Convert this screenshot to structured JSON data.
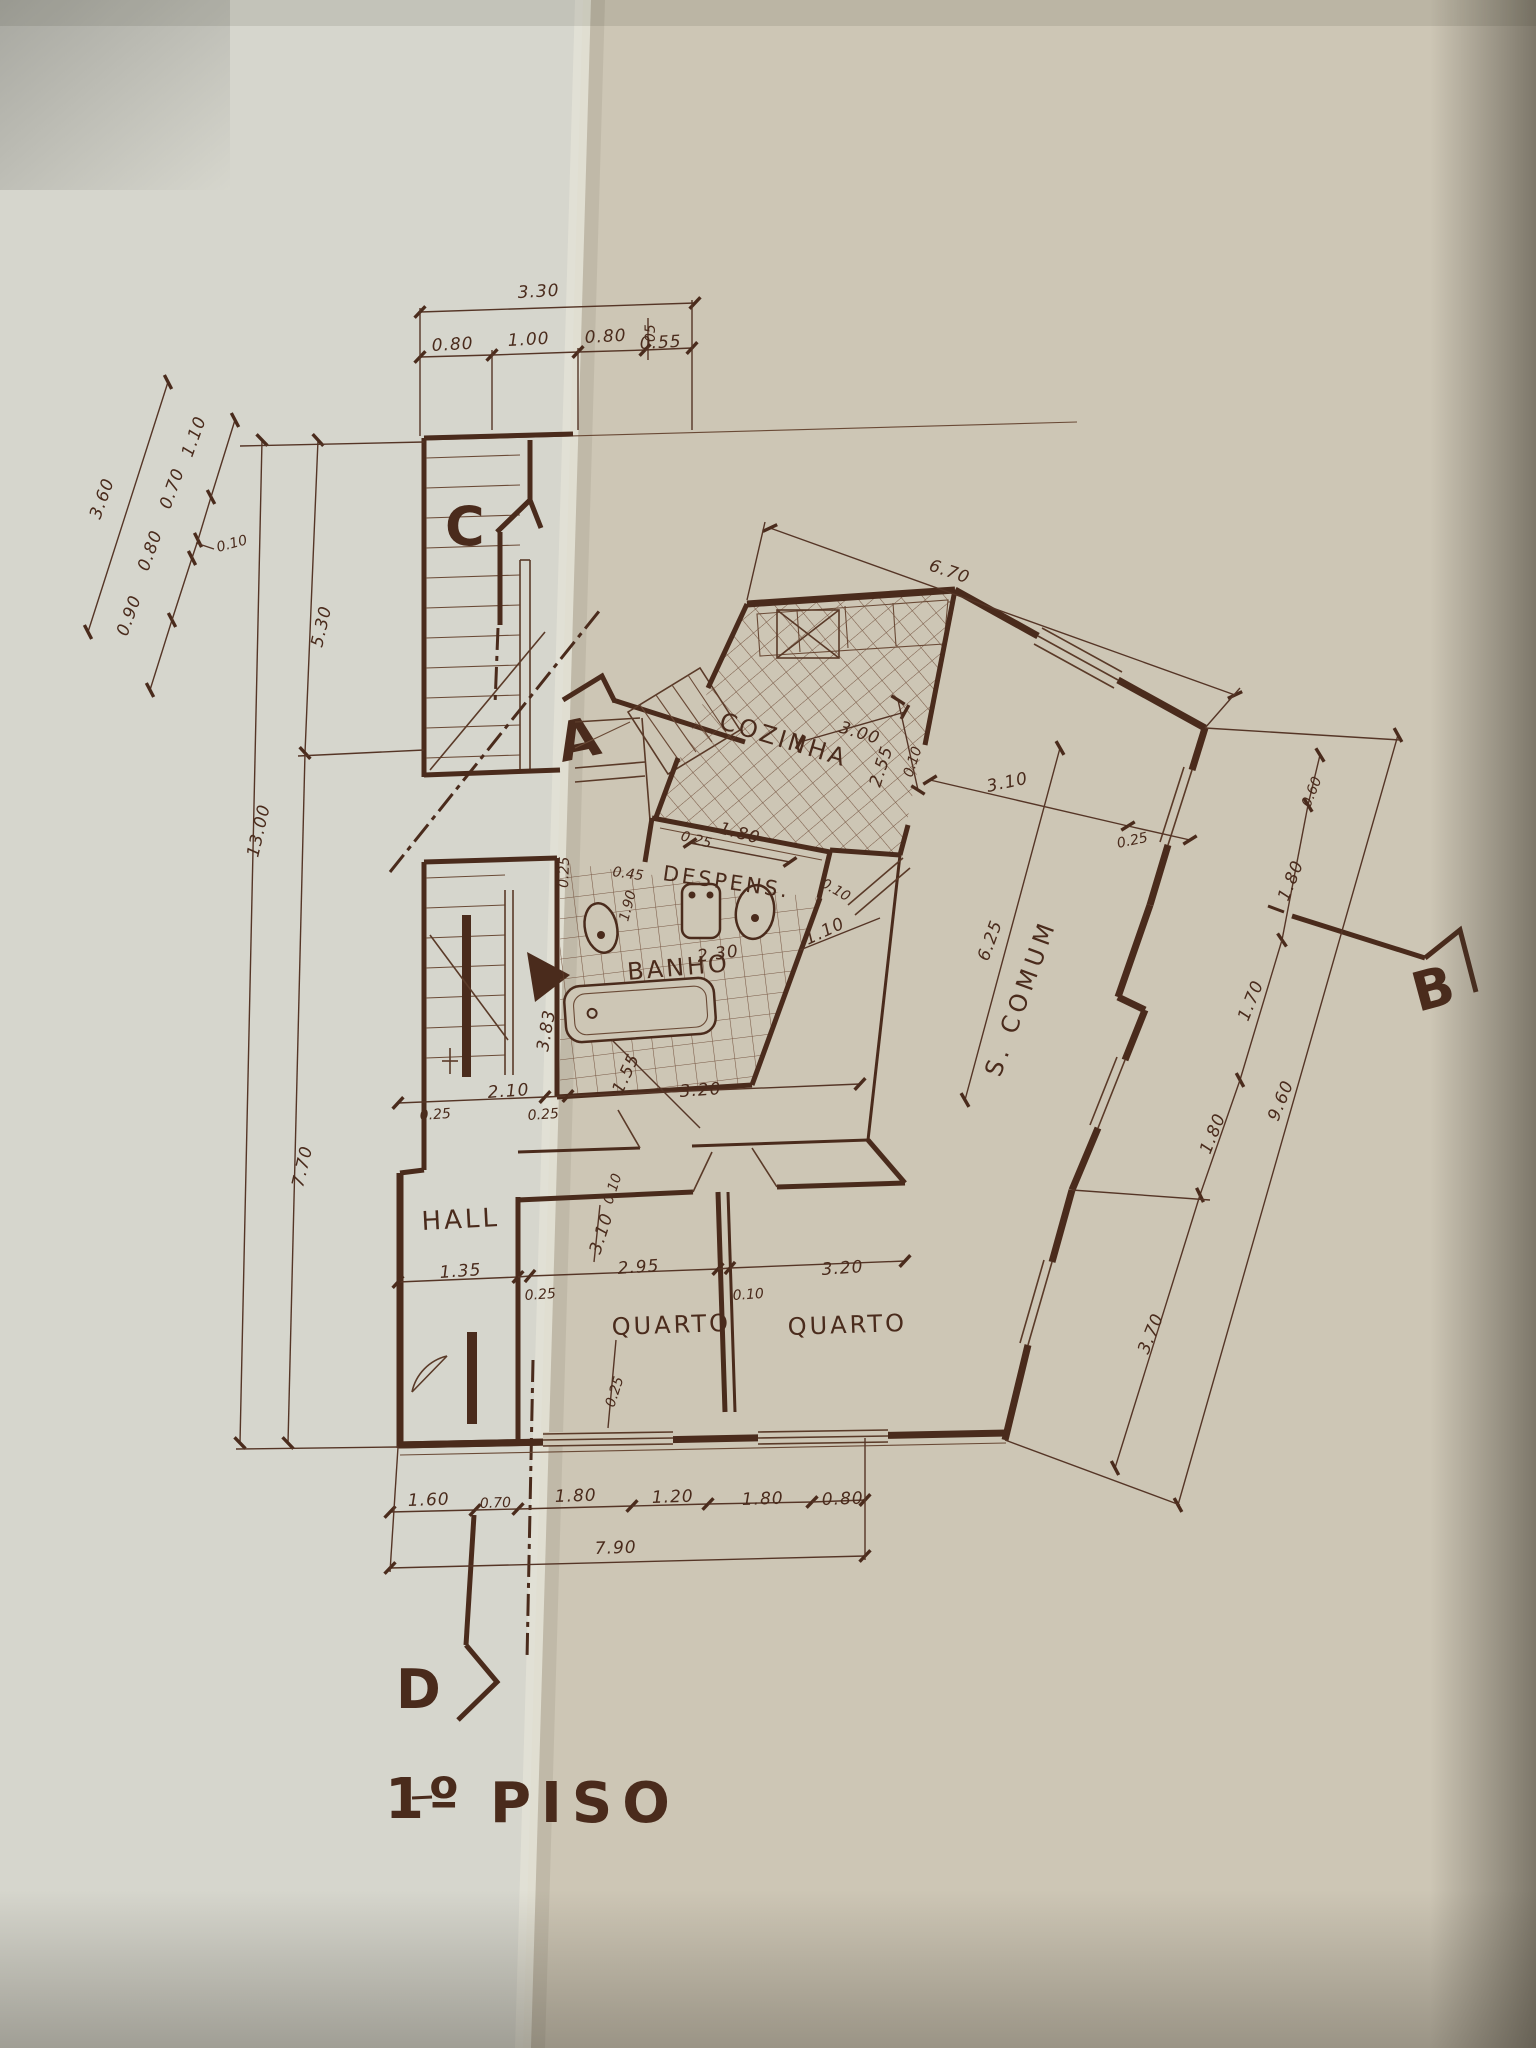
{
  "title": {
    "num": "1º",
    "word": "PISO"
  },
  "markers": {
    "a": "A",
    "b": "B",
    "c": "C",
    "d": "D"
  },
  "rooms": {
    "kitchen": "COZINHA",
    "pantry": "DESPENS.",
    "bath": "BANHO",
    "hall": "HALL",
    "bedroom1": "QUARTO",
    "bedroom2": "QUARTO",
    "living": "S. COMUM"
  },
  "dims": {
    "top": {
      "total": "3.30",
      "s1": "0.80",
      "s2": "1.00",
      "s3": "0.80",
      "s4": "0.55",
      "s5": "05"
    },
    "left_diag": {
      "total": "3.60",
      "s1": "1.10",
      "s2": "0.70",
      "note": "0.10",
      "s3": "0.80",
      "s4": "0.90"
    },
    "left_vert": {
      "upper": "5.30",
      "total": "13.00",
      "lower": "7.70"
    },
    "kitchen": {
      "top_total": "6.70",
      "width": "3.00",
      "depth": "2.55",
      "wall": "0.10"
    },
    "pantry": {
      "width": "1.80",
      "wall_left": "0.25",
      "niche": "0.45",
      "side": "0.25",
      "depth": "1.90",
      "wall_right": "0.10"
    },
    "bath": {
      "width": "2.30",
      "door": "1.10",
      "jog": "1.55",
      "depth": "3.83"
    },
    "living": {
      "top": "3.10",
      "wall": "0.25",
      "depth": "6.25",
      "r1": "0.60",
      "r2": "1.80",
      "r3": "1.70",
      "r4": "1.80",
      "r5": "3.70",
      "right_total": "9.60"
    },
    "mid": {
      "wall_l": "0.25",
      "s1": "2.10",
      "wall_m": "0.25",
      "s2": "3.20"
    },
    "bed": {
      "hall": "1.35",
      "wall_l": "0.25",
      "h1": "3.10",
      "n1": "0.10",
      "w1": "2.95",
      "wall_m": "0.10",
      "w2": "3.20",
      "v1": "0.25"
    },
    "bottom": {
      "s1": "1.60",
      "s2": "0.70",
      "s3": "1.80",
      "s4": "1.20",
      "s5": "1.80",
      "s6": "0.80",
      "total": "7.90"
    }
  },
  "colors": {
    "paper_left": "#d6d6cd",
    "paper_right": "#cdc6b5",
    "ink": "#4a2b1c"
  }
}
